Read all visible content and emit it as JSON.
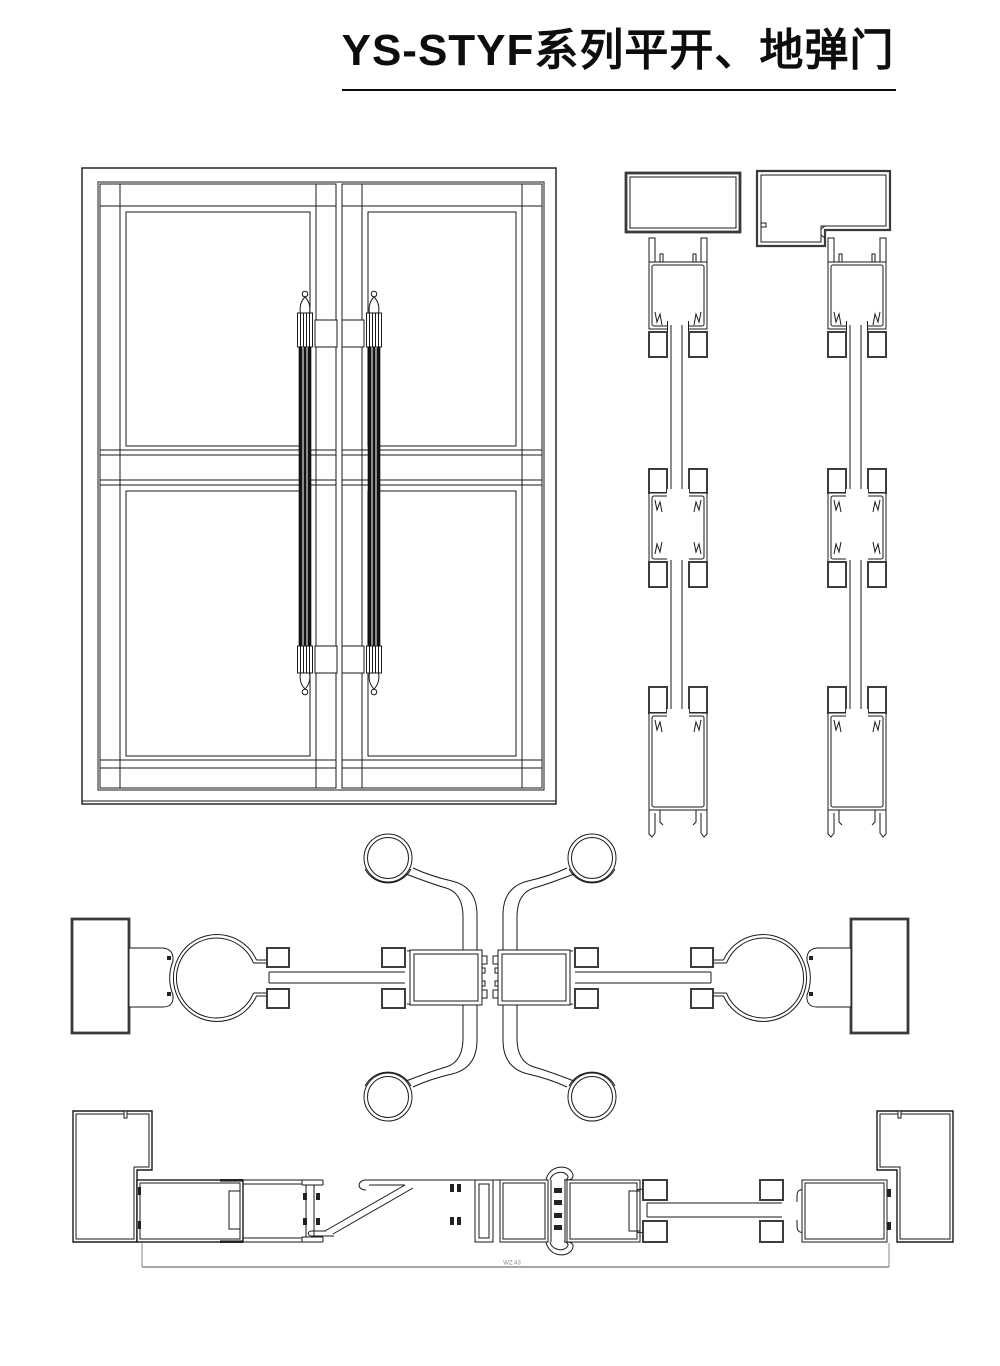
{
  "header": {
    "title": "YS-STYF系列平开、地弹门"
  },
  "dimension": {
    "label": "WZ.43"
  },
  "colors": {
    "line": "#1a1a1a",
    "thick_outline": "#3a3a3a",
    "handle_fill": "#141414",
    "dimension_line": "#8a8a8a",
    "background": "#ffffff",
    "title_text": "#0d0d0d"
  }
}
